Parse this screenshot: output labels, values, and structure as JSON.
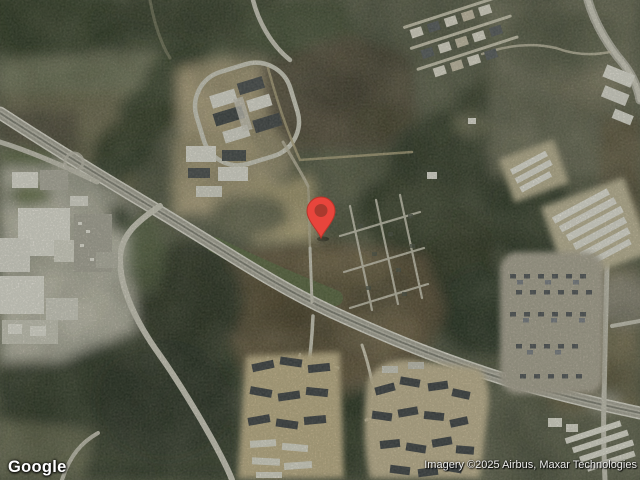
{
  "map": {
    "view": "satellite",
    "provider_logo": "Google",
    "attribution": "Imagery ©2025 Airbus, Maxar Technologies"
  },
  "marker": {
    "transform": "translate(321,238)",
    "body_color": "#E8453C",
    "body_stroke": "#B8352A",
    "inner_dot_color": "#A93A2E"
  },
  "palette": {
    "forest_dark": "#323A2B",
    "scrub_olive": "#5E614E",
    "field_brown": "#63553E",
    "field_tan": "#C6B689",
    "road_light": "#CFCCC0",
    "building_white": "#EDEBE2",
    "roof_dark": "#3E4247"
  }
}
